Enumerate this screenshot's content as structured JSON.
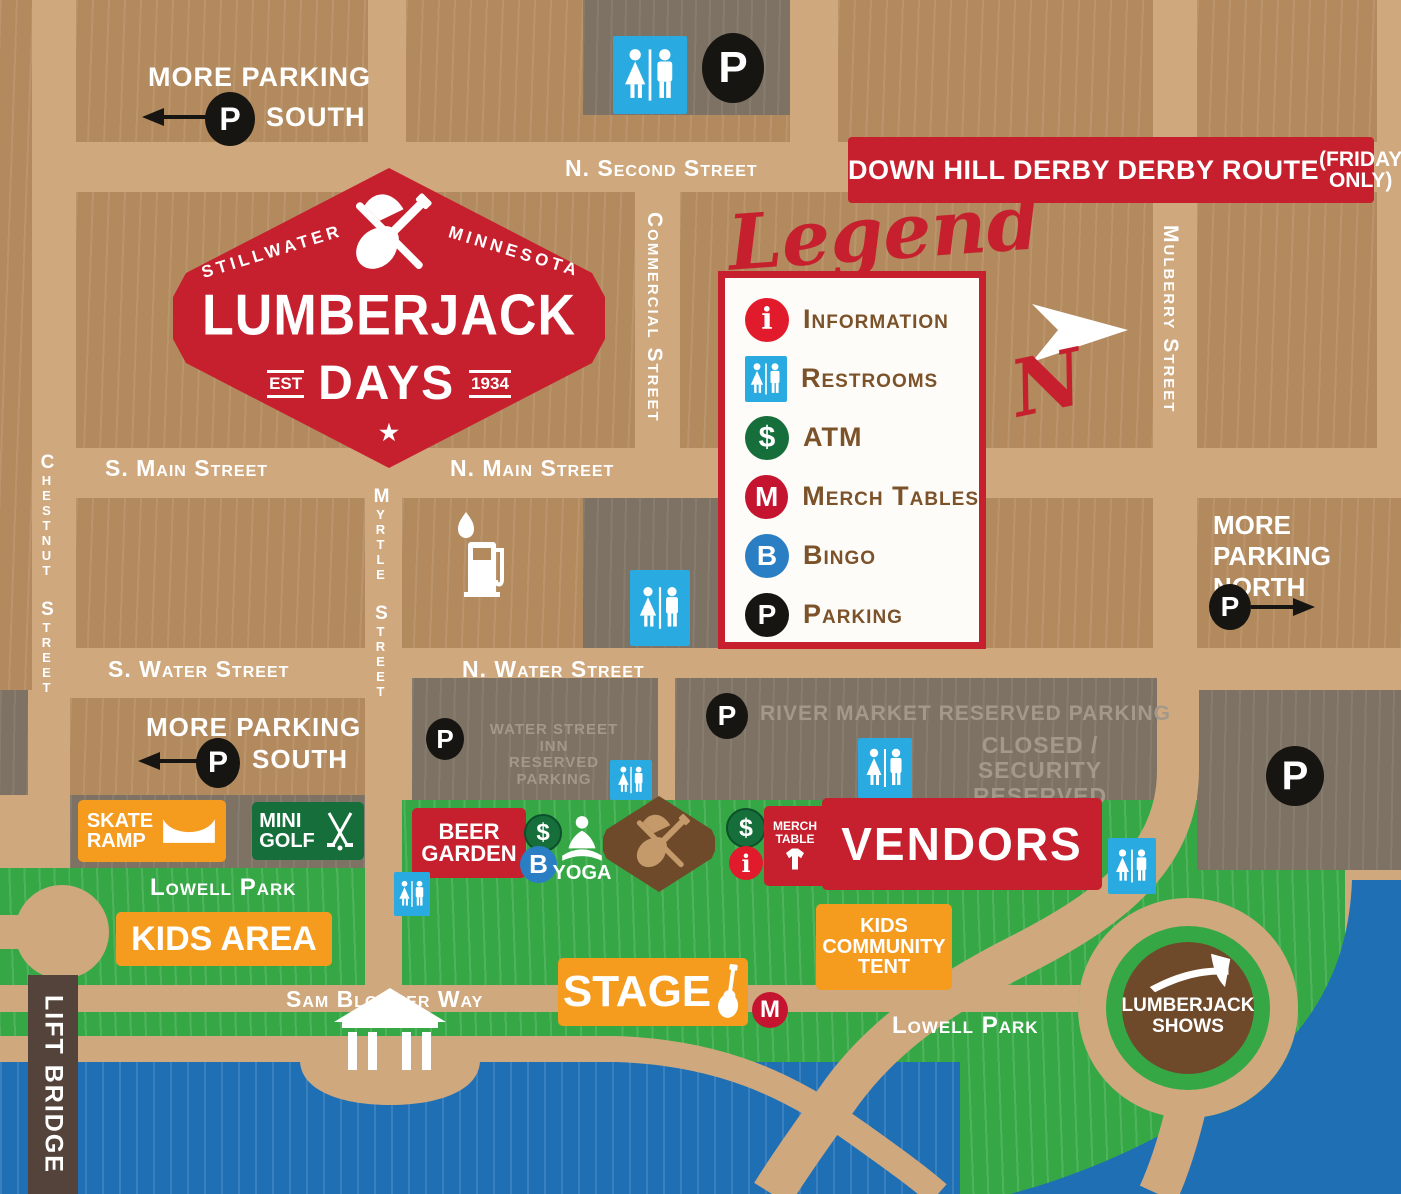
{
  "badge": {
    "city_left": "STILLWATER",
    "state_right": "MINNESOTA",
    "title": "LUMBERJACK",
    "subtitle": "DAYS",
    "est_label": "EST",
    "est_year": "1934",
    "star": "★"
  },
  "banner": {
    "title": "DOWN HILL DERBY DERBY ROUTE",
    "note_line1": "(FRIDAY",
    "note_line2": "ONLY)"
  },
  "legend": {
    "title": "Legend",
    "items": [
      {
        "label": "Information",
        "glyph": "i"
      },
      {
        "label": "Restrooms",
        "glyph": ""
      },
      {
        "label": "ATM",
        "glyph": "$"
      },
      {
        "label": "Merch Tables",
        "glyph": "M"
      },
      {
        "label": "Bingo",
        "glyph": "B"
      },
      {
        "label": "Parking",
        "glyph": "P"
      }
    ]
  },
  "north_letter": "N",
  "streets": {
    "n_second": "N. Second Street",
    "s_main": "S. Main Street",
    "n_main": "N. Main Street",
    "s_water": "S. Water Street",
    "n_water": "N. Water Street",
    "chestnut": "Chestnut Street",
    "myrtle": "Myrtle Street",
    "commercial": "Commercial Street",
    "mulberry": "Mulberry Street",
    "sam_bloomer": "Sam Bloomer Way",
    "lift_bridge": "LIFT BRIDGE"
  },
  "parking": {
    "more_south_top": {
      "line1": "MORE PARKING",
      "line2": "SOUTH"
    },
    "more_south_bottom": {
      "line1": "MORE PARKING",
      "line2": "SOUTH"
    },
    "more_north": {
      "line1": "MORE",
      "line2": "PARKING",
      "line3": "NORTH"
    },
    "water_street_inn": {
      "line1": "WATER STREET INN",
      "line2": "RESERVED PARKING"
    },
    "river_market": "RIVER MARKET RESERVED PARKING",
    "closed_security": {
      "line1": "CLOSED / SECURITY",
      "line2": "RESERVED PARKING"
    }
  },
  "areas": {
    "skate_ramp": {
      "line1": "SKATE",
      "line2": "RAMP"
    },
    "mini_golf": {
      "line1": "MINI",
      "line2": "GOLF"
    },
    "beer_garden": {
      "line1": "BEER",
      "line2": "GARDEN"
    },
    "yoga": "YOGA",
    "merch_table": {
      "line1": "MERCH",
      "line2": "TABLE"
    },
    "vendors": "VENDORS",
    "kids_area": "KIDS AREA",
    "stage": "STAGE",
    "kids_tent": {
      "line1": "KIDS",
      "line2": "COMMUNITY",
      "line3": "TENT"
    },
    "lumberjack_shows": {
      "line1": "LUMBERJACK",
      "line2": "SHOWS"
    },
    "lowell_park_left": "Lowell Park",
    "lowell_park_right": "Lowell Park"
  },
  "glyphs": {
    "dollar": "$",
    "bingo": "B",
    "info": "i",
    "merch": "M",
    "parking": "P"
  },
  "colors": {
    "red": "#c6202e",
    "orange": "#f59b1e",
    "green_dark": "#166f3b",
    "restroom_blue": "#29abe2",
    "bingo_blue": "#2a7ec4",
    "info_red": "#e11b2b",
    "merch_red": "#c41430",
    "black": "#171512",
    "park_green": "#35a845",
    "water_blue": "#1f6fb5",
    "road_tan": "#cfa87e",
    "block_tan": "#b28a5e",
    "lot_gray": "#7d7263",
    "brown": "#6f4a2a"
  }
}
